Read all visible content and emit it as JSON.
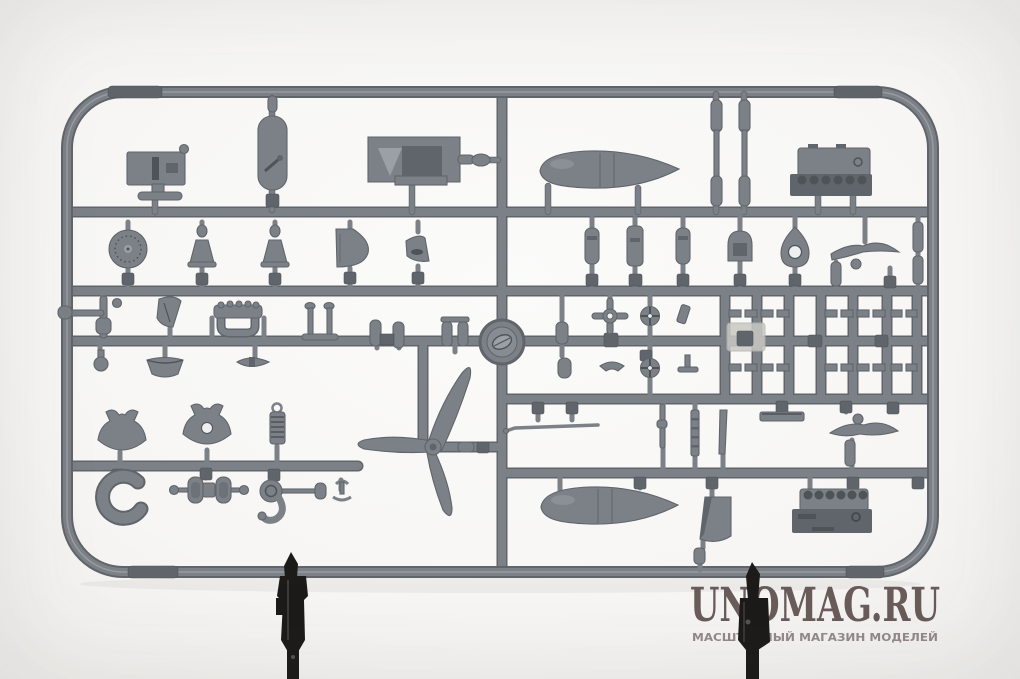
{
  "watermark": {
    "title": "UNOMAG.RU",
    "subtitle": "МАСШТАБНЫЙ МАГАЗИН МОДЕЛЕЙ"
  },
  "colors": {
    "background": "#f4f3f1",
    "plastic": "#7c8187",
    "plastic_dark": "#60656b",
    "plastic_deep": "#4e5358",
    "plastic_light": "#9aa0a6",
    "clamp": "#1d1b1a",
    "clear_part": "#c9c9c3",
    "watermark_title": "#5a4c4a",
    "watermark_subtitle": "#93898a"
  },
  "subject": {
    "type": "model-kit-sprue-photo",
    "plastic_color_name": "gray",
    "visible_parts": [
      "sprue-frame",
      "molding-tab",
      "instrument-panel",
      "oval-access-panel",
      "main-wheel-disc",
      "control-horn-left",
      "control-horn-right",
      "wing-fairing",
      "small-fairing",
      "bomb-rack-assembly",
      "drop-tank-upper",
      "strut-column-pair",
      "engine-block-upper",
      "row-capsule-parts",
      "piston-cap-part",
      "eyelet-bracket",
      "wing-bracket-upper",
      "ball-rod-assembly",
      "curved-flap",
      "exhaust-manifold",
      "twin-post-stand",
      "capsule-pair",
      "ball-pommel",
      "bowl-fairing",
      "mini-blade-part",
      "cross-joint-part",
      "spoked-wheel-upper",
      "spoked-wheel-lower",
      "clear-insert-part",
      "small-parts-grid",
      "center-logo-boss",
      "three-blade-propeller",
      "pitot-strip",
      "narrow-strips",
      "flat-plate-part",
      "wing-bracket-lower",
      "drop-tank-lower",
      "air-scoop",
      "engine-block-lower",
      "cowl-flap-left",
      "cowl-flap-right",
      "coil-spring-part",
      "horseshoe-mount",
      "wheel-axle-assembly",
      "hook-disc-part",
      "display-clamp-left",
      "display-clamp-right"
    ]
  }
}
